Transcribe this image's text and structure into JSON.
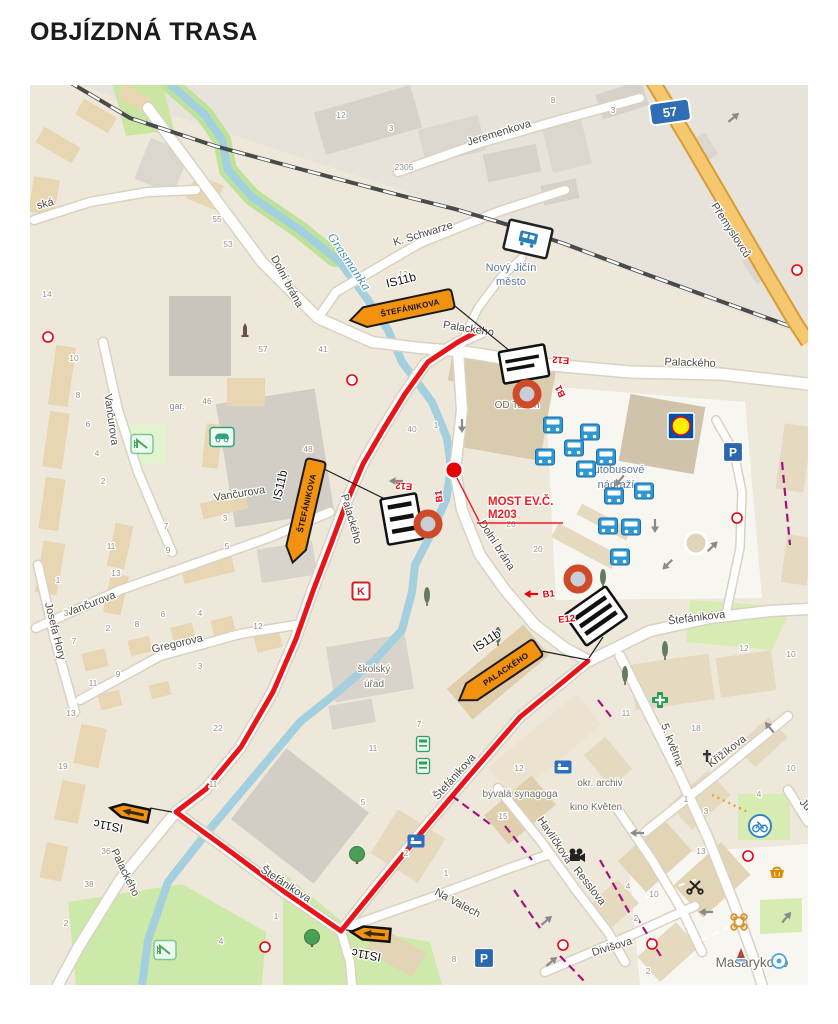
{
  "page": {
    "title": "OBJÍZDNÁ TRASA"
  },
  "map": {
    "colors": {
      "route_red": "#e60005",
      "sign_orange": "#f2920e",
      "code_red": "#e8000a",
      "bridge_red": "#ed1c24",
      "water": "#a3cfdf",
      "road_orange": "#f5c76f",
      "shield_blue": "#2f6db5",
      "bus_blue": "#2e97d4",
      "purple": "#a4117e"
    },
    "route_shield": {
      "text": "57",
      "x": 670,
      "y": 112,
      "rot": -8
    },
    "bridge_label": {
      "line1": "MOST EV.Č.",
      "line2": "M203",
      "x": 488,
      "y": 505
    },
    "street_labels": [
      {
        "t": "Jeremenkova",
        "x": 500,
        "y": 136,
        "r": -17
      },
      {
        "t": "Přemyslovců",
        "x": 728,
        "y": 232,
        "r": 57
      },
      {
        "t": "K. Schwarze",
        "x": 424,
        "y": 237,
        "r": -17
      },
      {
        "t": "ská",
        "x": 46,
        "y": 207,
        "r": -14
      },
      {
        "t": "Dolní brána",
        "x": 284,
        "y": 283,
        "r": 62
      },
      {
        "t": "Palackého",
        "x": 468,
        "y": 332,
        "r": 9
      },
      {
        "t": "Palackého",
        "x": 690,
        "y": 366,
        "r": 2
      },
      {
        "t": "Palackého",
        "x": 348,
        "y": 520,
        "r": 74
      },
      {
        "t": "Dolní brána",
        "x": 494,
        "y": 547,
        "r": 57
      },
      {
        "t": "Vančurova",
        "x": 108,
        "y": 420,
        "r": 82
      },
      {
        "t": "Vančurova",
        "x": 240,
        "y": 497,
        "r": -9
      },
      {
        "t": "Vančurova",
        "x": 92,
        "y": 607,
        "r": -21
      },
      {
        "t": "Josefa Hory",
        "x": 52,
        "y": 632,
        "r": 76
      },
      {
        "t": "Gregorova",
        "x": 178,
        "y": 647,
        "r": -13
      },
      {
        "t": "Palackého",
        "x": 122,
        "y": 874,
        "r": 64
      },
      {
        "t": "Štefánikova",
        "x": 284,
        "y": 887,
        "r": 33
      },
      {
        "t": "Štefánikova",
        "x": 457,
        "y": 779,
        "r": -48
      },
      {
        "t": "Štefánikova",
        "x": 697,
        "y": 621,
        "r": -7
      },
      {
        "t": "Na Valech",
        "x": 456,
        "y": 906,
        "r": 28
      },
      {
        "t": "5. května",
        "x": 669,
        "y": 746,
        "r": 69
      },
      {
        "t": "Křižíkova",
        "x": 729,
        "y": 754,
        "r": -38
      },
      {
        "t": "Havlíčkova",
        "x": 552,
        "y": 842,
        "r": 56
      },
      {
        "t": "Resslova",
        "x": 587,
        "y": 888,
        "r": 52
      },
      {
        "t": "Divišova",
        "x": 613,
        "y": 950,
        "r": -17
      },
      {
        "t": "Ju",
        "x": 803,
        "y": 807,
        "r": 48
      }
    ],
    "place_labels": [
      {
        "t": "Grasmanka",
        "x": 346,
        "y": 264,
        "r": 56,
        "cls": "water-lbl"
      },
      {
        "t": "Nový Jičín",
        "x": 511,
        "y": 271,
        "r": 0,
        "cls": "station-lbl"
      },
      {
        "t": "město",
        "x": 511,
        "y": 285,
        "r": 0,
        "cls": "station-lbl"
      },
      {
        "t": "OD Teben",
        "x": 517,
        "y": 408,
        "r": 0,
        "cls": "poi-lbl"
      },
      {
        "t": "autobusové",
        "x": 616,
        "y": 473,
        "r": 0,
        "cls": "station-lbl"
      },
      {
        "t": "nádraží",
        "x": 616,
        "y": 488,
        "r": 0,
        "cls": "station-lbl"
      },
      {
        "t": "školský",
        "x": 374,
        "y": 672,
        "r": 0,
        "cls": "poi-lbl"
      },
      {
        "t": "úřad",
        "x": 374,
        "y": 687,
        "r": 0,
        "cls": "poi-lbl"
      },
      {
        "t": "bývalá synagoga",
        "x": 520,
        "y": 797,
        "r": 0,
        "cls": "poi-lbl"
      },
      {
        "t": "okr. archiv",
        "x": 600,
        "y": 786,
        "r": 0,
        "cls": "poi-lbl"
      },
      {
        "t": "kino Květen",
        "x": 596,
        "y": 810,
        "r": 0,
        "cls": "poi-lbl"
      },
      {
        "t": "Masarykovo",
        "x": 752,
        "y": 967,
        "r": 0,
        "cls": "big-lbl"
      },
      {
        "t": "gar.",
        "x": 177,
        "y": 409,
        "r": 0,
        "cls": "small-lbl"
      }
    ],
    "house_numbers": [
      [
        "8",
        553,
        103
      ],
      [
        "3",
        613,
        113
      ],
      [
        "12",
        341,
        118
      ],
      [
        "3",
        391,
        131
      ],
      [
        "2305",
        404,
        170
      ],
      [
        "55",
        217,
        222
      ],
      [
        "53",
        228,
        247
      ],
      [
        "14",
        47,
        297
      ],
      [
        "13",
        403,
        277
      ],
      [
        "57",
        263,
        352
      ],
      [
        "41",
        323,
        352
      ],
      [
        "10",
        74,
        361
      ],
      [
        "8",
        78,
        398
      ],
      [
        "46",
        207,
        404
      ],
      [
        "6",
        88,
        427
      ],
      [
        "4",
        97,
        456
      ],
      [
        "2",
        103,
        484
      ],
      [
        "48",
        308,
        452
      ],
      [
        "40",
        412,
        432
      ],
      [
        "1",
        436,
        428
      ],
      [
        "3",
        225,
        521
      ],
      [
        "5",
        227,
        549
      ],
      [
        "7",
        166,
        529
      ],
      [
        "9",
        168,
        553
      ],
      [
        "11",
        111,
        549
      ],
      [
        "13",
        116,
        576
      ],
      [
        "1",
        58,
        583
      ],
      [
        "3",
        66,
        616
      ],
      [
        "7",
        74,
        644
      ],
      [
        "2",
        108,
        631
      ],
      [
        "8",
        137,
        627
      ],
      [
        "6",
        163,
        617
      ],
      [
        "4",
        200,
        616
      ],
      [
        "12",
        258,
        629
      ],
      [
        "9",
        118,
        677
      ],
      [
        "11",
        93,
        686
      ],
      [
        "3",
        200,
        669
      ],
      [
        "13",
        71,
        716
      ],
      [
        "19",
        63,
        769
      ],
      [
        "22",
        218,
        731
      ],
      [
        "11",
        213,
        787
      ],
      [
        "36",
        106,
        854
      ],
      [
        "38",
        89,
        887
      ],
      [
        "2",
        66,
        926
      ],
      [
        "1",
        276,
        919
      ],
      [
        "4",
        221,
        944
      ],
      [
        "20",
        538,
        552
      ],
      [
        "26",
        511,
        527
      ],
      [
        "13",
        521,
        667
      ],
      [
        "12",
        519,
        771
      ],
      [
        "11",
        373,
        751
      ],
      [
        "5",
        363,
        805
      ],
      [
        "7",
        419,
        727
      ],
      [
        "15",
        503,
        819
      ],
      [
        "2",
        406,
        856
      ],
      [
        "1",
        446,
        876
      ],
      [
        "4",
        628,
        889
      ],
      [
        "8",
        454,
        962
      ],
      [
        "12",
        744,
        651
      ],
      [
        "10",
        791,
        657
      ],
      [
        "18",
        696,
        731
      ],
      [
        "11",
        626,
        716
      ],
      [
        "10",
        791,
        771
      ],
      [
        "4",
        759,
        797
      ],
      [
        "3",
        706,
        814
      ],
      [
        "1",
        686,
        802
      ],
      [
        "13",
        701,
        854
      ],
      [
        "10",
        654,
        897
      ],
      [
        "2",
        636,
        921
      ],
      [
        "2",
        648,
        974
      ]
    ],
    "detour_signs": [
      {
        "type": "IS11b",
        "label": "ŠTEFÁNIKOVA",
        "x": 408,
        "y": 308,
        "rot": -12,
        "len": 88
      },
      {
        "type": "IS11b",
        "label": "ŠTEFÁNIKOVA",
        "x": 306,
        "y": 505,
        "rot": -77,
        "len": 88
      },
      {
        "type": "IS11b",
        "label": "PALACKÉHO",
        "x": 504,
        "y": 670,
        "rot": -34,
        "len": 78
      },
      {
        "type": "IS11c",
        "label": "",
        "x": 134,
        "y": 813,
        "rot": 12,
        "len": 34
      },
      {
        "type": "IS11c",
        "label": "",
        "x": 375,
        "y": 934,
        "rot": 5,
        "len": 34
      }
    ],
    "sign_labels": [
      {
        "t": "IS11b",
        "x": 402,
        "y": 284,
        "r": -14
      },
      {
        "t": "IS11b",
        "x": 284,
        "y": 486,
        "r": -77
      },
      {
        "t": "IS11b",
        "x": 489,
        "y": 644,
        "r": -34
      },
      {
        "t": "IS11c",
        "x": 109,
        "y": 822,
        "r": 190
      },
      {
        "t": "IS11c",
        "x": 367,
        "y": 951,
        "r": 190
      }
    ],
    "closure_groups": [
      {
        "sign": {
          "x": 524,
          "y": 364,
          "w": 46,
          "h": 32,
          "rot": -10,
          "style": "text"
        },
        "circle": {
          "x": 527,
          "y": 394
        },
        "codes": [
          {
            "t": "E12",
            "x": 561,
            "y": 357,
            "r": 184
          },
          {
            "t": "B1",
            "x": 563,
            "y": 390,
            "r": 246
          }
        ]
      },
      {
        "sign": {
          "x": 402,
          "y": 519,
          "w": 36,
          "h": 46,
          "rot": -10,
          "style": "bars"
        },
        "circle": {
          "x": 428,
          "y": 524
        },
        "codes": [
          {
            "t": "E12",
            "x": 404,
            "y": 483,
            "r": 184
          },
          {
            "t": "B1",
            "x": 442,
            "y": 496,
            "r": 264
          }
        ],
        "arrow": {
          "x": 397,
          "y": 481,
          "r": 180,
          "c": "#8a8a8a"
        }
      },
      {
        "sign": {
          "x": 596,
          "y": 616,
          "w": 50,
          "h": 38,
          "rot": -35,
          "style": "bars"
        },
        "circle": {
          "x": 578,
          "y": 579
        },
        "codes": [
          {
            "t": "B1",
            "x": 549,
            "y": 597,
            "r": -6
          },
          {
            "t": "E12",
            "x": 567,
            "y": 622,
            "r": -6
          }
        ],
        "arrow": {
          "x": 532,
          "y": 594,
          "r": 180,
          "c": "#e8000a"
        }
      }
    ],
    "closure_point": {
      "x": 454,
      "y": 470
    },
    "poi_icons": [
      {
        "n": "bus",
        "x": 553,
        "y": 425
      },
      {
        "n": "bus",
        "x": 590,
        "y": 432
      },
      {
        "n": "bus",
        "x": 545,
        "y": 457
      },
      {
        "n": "bus",
        "x": 574,
        "y": 448
      },
      {
        "n": "bus",
        "x": 606,
        "y": 457
      },
      {
        "n": "bus",
        "x": 586,
        "y": 469
      },
      {
        "n": "bus",
        "x": 614,
        "y": 496
      },
      {
        "n": "bus",
        "x": 644,
        "y": 491
      },
      {
        "n": "bus",
        "x": 608,
        "y": 526
      },
      {
        "n": "bus",
        "x": 631,
        "y": 527
      },
      {
        "n": "bus",
        "x": 620,
        "y": 557
      },
      {
        "n": "train-station",
        "x": 528,
        "y": 239
      },
      {
        "n": "lidl",
        "x": 681,
        "y": 426
      },
      {
        "n": "parking",
        "x": 733,
        "y": 452
      },
      {
        "n": "parking",
        "x": 484,
        "y": 958
      },
      {
        "n": "hotel",
        "x": 563,
        "y": 767
      },
      {
        "n": "hotel",
        "x": 416,
        "y": 841
      },
      {
        "n": "pharmacy",
        "x": 660,
        "y": 700
      },
      {
        "n": "bike",
        "x": 760,
        "y": 826
      },
      {
        "n": "bank-k",
        "x": 361,
        "y": 591
      },
      {
        "n": "cinema-camera",
        "x": 576,
        "y": 855
      },
      {
        "n": "scissors",
        "x": 695,
        "y": 886
      },
      {
        "n": "basket",
        "x": 777,
        "y": 872
      },
      {
        "n": "ornament",
        "x": 739,
        "y": 922
      },
      {
        "n": "fountain",
        "x": 741,
        "y": 955
      },
      {
        "n": "drink",
        "x": 779,
        "y": 961
      },
      {
        "n": "tree",
        "x": 312,
        "y": 938
      },
      {
        "n": "tree",
        "x": 357,
        "y": 855
      },
      {
        "n": "poplar",
        "x": 603,
        "y": 578
      },
      {
        "n": "poplar",
        "x": 498,
        "y": 636
      },
      {
        "n": "poplar",
        "x": 427,
        "y": 596
      },
      {
        "n": "poplar",
        "x": 625,
        "y": 675
      },
      {
        "n": "poplar",
        "x": 665,
        "y": 650
      },
      {
        "n": "playground",
        "x": 142,
        "y": 444
      },
      {
        "n": "playground",
        "x": 165,
        "y": 950
      },
      {
        "n": "car-service",
        "x": 222,
        "y": 437
      },
      {
        "n": "church-cross",
        "x": 707,
        "y": 757
      },
      {
        "n": "monument",
        "x": 245,
        "y": 330
      },
      {
        "n": "atm",
        "x": 423,
        "y": 744
      },
      {
        "n": "atm",
        "x": 423,
        "y": 766
      }
    ],
    "arrows": [
      {
        "x": 733,
        "y": 118,
        "r": -40
      },
      {
        "x": 462,
        "y": 425,
        "r": 90
      },
      {
        "x": 655,
        "y": 525,
        "r": 90
      },
      {
        "x": 712,
        "y": 547,
        "r": -45
      },
      {
        "x": 668,
        "y": 564,
        "r": 135
      },
      {
        "x": 620,
        "y": 480,
        "r": 130
      },
      {
        "x": 546,
        "y": 921,
        "r": -40
      },
      {
        "x": 551,
        "y": 962,
        "r": -40
      },
      {
        "x": 638,
        "y": 833,
        "r": 180
      },
      {
        "x": 707,
        "y": 912,
        "r": 180
      },
      {
        "x": 786,
        "y": 918,
        "r": -50
      },
      {
        "x": 770,
        "y": 728,
        "r": -130
      }
    ],
    "signals": [
      {
        "x": 352,
        "y": 380
      },
      {
        "x": 737,
        "y": 518
      },
      {
        "x": 797,
        "y": 270
      },
      {
        "x": 748,
        "y": 856
      },
      {
        "x": 652,
        "y": 944
      },
      {
        "x": 563,
        "y": 945
      },
      {
        "x": 265,
        "y": 947
      },
      {
        "x": 48,
        "y": 337
      }
    ]
  }
}
